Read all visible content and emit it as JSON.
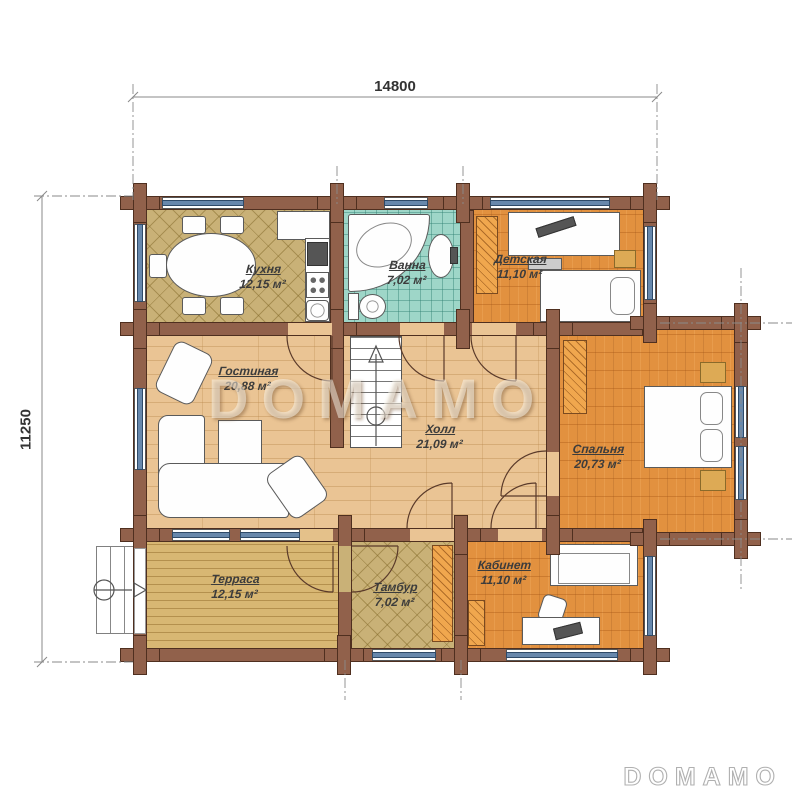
{
  "plan": {
    "dimensions": {
      "width": "14800",
      "height": "11250"
    },
    "watermark": "DOMAMO",
    "brand_logo": "DOMAMO",
    "rooms": [
      {
        "id": "kitchen",
        "name": "Кухня",
        "area": "12,15 м²"
      },
      {
        "id": "bath",
        "name": "Ванна",
        "area": "7,02 м²"
      },
      {
        "id": "nursery",
        "name": "Детская",
        "area": "11,10 м²"
      },
      {
        "id": "living",
        "name": "Гостиная",
        "area": "20,88 м²"
      },
      {
        "id": "hall",
        "name": "Холл",
        "area": "21,09 м²"
      },
      {
        "id": "bedroom",
        "name": "Спальня",
        "area": "20,73 м²"
      },
      {
        "id": "terrace",
        "name": "Терраса",
        "area": "12,15 м²"
      },
      {
        "id": "vestibule",
        "name": "Тамбур",
        "area": "7,02 м²"
      },
      {
        "id": "office",
        "name": "Кабинет",
        "area": "11,10 м²"
      }
    ],
    "colors": {
      "wall": "#91614b",
      "wall_outline": "#4f2f1f",
      "window_glass": "#6888ac",
      "kitchen_floor": "#c9b177",
      "bath_floor": "#9ed6c8",
      "parquet_floor": "#e2913f",
      "wood_floor": "#eac494",
      "terrace_floor": "#d8b773",
      "closet_hatch": "#f0a74e"
    }
  }
}
